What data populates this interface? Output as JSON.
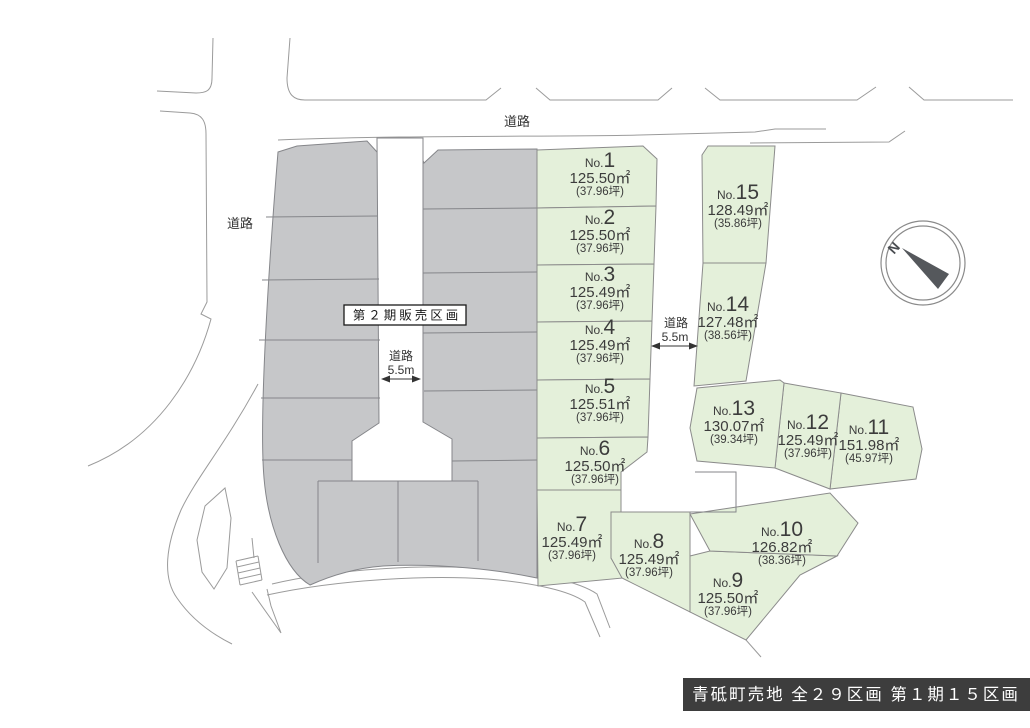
{
  "labels": {
    "road_top": "道路",
    "road_left": "道路",
    "phase2": "第２期販売区画",
    "road1_name": "道路",
    "road1_width": "5.5m",
    "road2_name": "道路",
    "road2_width": "5.5m",
    "compass_north": "N",
    "title": "青砥町売地 全２９区画 第１期１５区画"
  },
  "lots": [
    {
      "no_prefix": "No.",
      "no": "1",
      "area": "125.50㎡",
      "tsubo": "(37.96坪)"
    },
    {
      "no_prefix": "No.",
      "no": "2",
      "area": "125.50㎡",
      "tsubo": "(37.96坪)"
    },
    {
      "no_prefix": "No.",
      "no": "3",
      "area": "125.49㎡",
      "tsubo": "(37.96坪)"
    },
    {
      "no_prefix": "No.",
      "no": "4",
      "area": "125.49㎡",
      "tsubo": "(37.96坪)"
    },
    {
      "no_prefix": "No.",
      "no": "5",
      "area": "125.51㎡",
      "tsubo": "(37.96坪)"
    },
    {
      "no_prefix": "No.",
      "no": "6",
      "area": "125.50㎡",
      "tsubo": "(37.96坪)"
    },
    {
      "no_prefix": "No.",
      "no": "7",
      "area": "125.49㎡",
      "tsubo": "(37.96坪)"
    },
    {
      "no_prefix": "No.",
      "no": "8",
      "area": "125.49㎡",
      "tsubo": "(37.96坪)"
    },
    {
      "no_prefix": "No.",
      "no": "9",
      "area": "125.50㎡",
      "tsubo": "(37.96坪)"
    },
    {
      "no_prefix": "No.",
      "no": "10",
      "area": "126.82㎡",
      "tsubo": "(38.36坪)"
    },
    {
      "no_prefix": "No.",
      "no": "11",
      "area": "151.98㎡",
      "tsubo": "(45.97坪)"
    },
    {
      "no_prefix": "No.",
      "no": "12",
      "area": "125.49㎡",
      "tsubo": "(37.96坪)"
    },
    {
      "no_prefix": "No.",
      "no": "13",
      "area": "130.07㎡",
      "tsubo": "(39.34坪)"
    },
    {
      "no_prefix": "No.",
      "no": "14",
      "area": "127.48㎡",
      "tsubo": "(38.56坪)"
    },
    {
      "no_prefix": "No.",
      "no": "15",
      "area": "128.49㎡",
      "tsubo": "(35.86坪)"
    }
  ],
  "colors": {
    "lot_green": "#e4f0da",
    "phase2_gray": "#c6c7c9",
    "title_bg": "#3d3d3d",
    "outline": "#8b8b8b"
  }
}
